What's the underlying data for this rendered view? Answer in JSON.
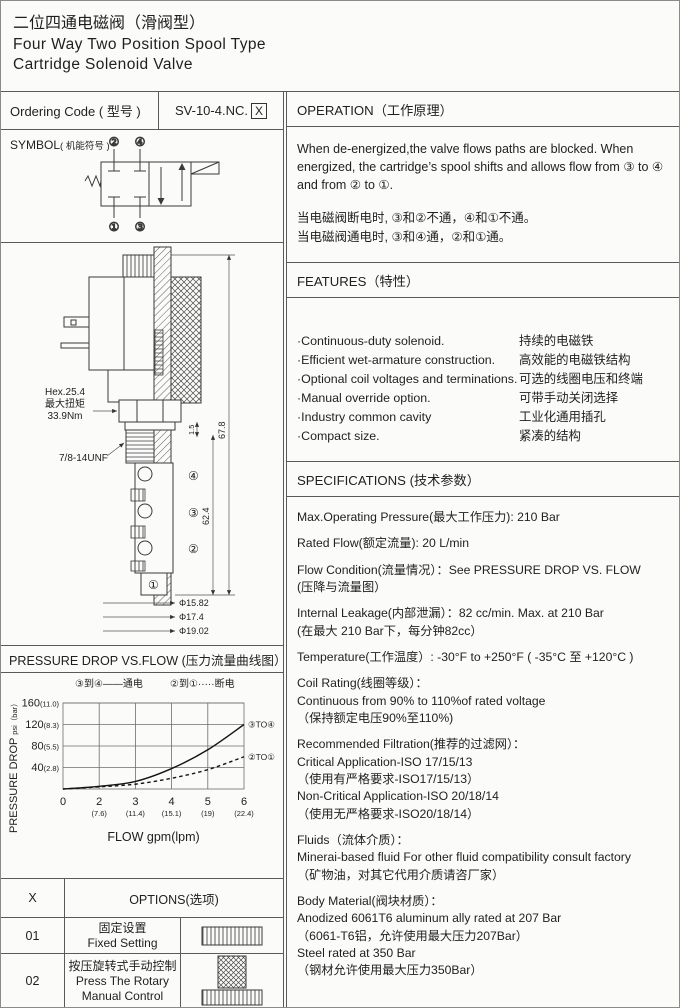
{
  "header": {
    "title_zh": "二位四通电磁阀（滑阀型）",
    "title_en1": "Four Way Two Position Spool Type",
    "title_en2": "Cartridge Solenoid Valve"
  },
  "ordering": {
    "label": "Ordering Code ( 型号 )",
    "code": "SV-10-4.NC.",
    "suffix": "X"
  },
  "symbol": {
    "label": "SYMBOL",
    "label_zh": "( 机能符号 )",
    "ports": [
      "②",
      "④",
      "①",
      "③"
    ],
    "icon_names": [
      "solenoid-actuator-icon",
      "return-spring-icon",
      "flow-arrow-icon",
      "blocked-port-icon"
    ]
  },
  "drawing": {
    "hex_line1": "Hex.25.4",
    "hex_line2": "最大扭矩",
    "hex_line3": "33.9Nm",
    "thread_label": "7/8-14UNF",
    "dim_total": "67.8",
    "dim_gap": "1.5",
    "dim_body": "62.4",
    "dia": [
      "Φ15.82",
      "Φ17.4",
      "Φ19.02"
    ],
    "ports": [
      "④",
      "③",
      "②",
      "①"
    ]
  },
  "operation": {
    "header": "OPERATION（工作原理）",
    "text_en": "When de-energized,the valve flows paths are blocked. When energized, the cartridge’s spool shifts and allows flow from ③ to ④ and from ② to ①.",
    "text_zh": "当电磁阀断电时, ③和②不通，④和①不通。\n当电磁阀通电时, ③和④通，②和①通。"
  },
  "features": {
    "header": "FEATURES（特性）",
    "items": [
      {
        "en": "·Continuous-duty  solenoid.",
        "zh": "持续的电磁铁"
      },
      {
        "en": "·Efficient wet-armature construction.",
        "zh": "高效能的电磁铁结构"
      },
      {
        "en": "·Optional coil voltages and terminations.",
        "zh": "可选的线圈电压和终端"
      },
      {
        "en": "·Manual override option.",
        "zh": "可带手动关闭选择"
      },
      {
        "en": "·Industry common cavity",
        "zh": "工业化通用插孔"
      },
      {
        "en": "·Compact size.",
        "zh": "紧凑的结构"
      }
    ]
  },
  "specifications": {
    "header": "SPECIFICATIONS (技术参数）",
    "blocks": [
      "Max.Operating Pressure(最大工作压力): 210 Bar",
      "Rated Flow(额定流量): 20 L/min",
      "Flow Condition(流量情况）：See PRESSURE DROP VS. FLOW\n(压降与流量图）",
      "Internal Leakage(内部泄漏）：82 cc/min. Max. at 210 Bar\n(在最大 210 Bar下，每分钟82cc）",
      "Temperature(工作温度）: -30°F to +250°F  ( -35°C 至 +120°C )",
      "Coil Rating(线圈等级）：\nContinuous from 90% to 110%of rated voltage\n（保持额定电压90%至110%)",
      "Recommended Filtration(推荐的过滤网）：\nCritical Application-ISO 17/15/13\n（使用有严格要求-ISO17/15/13）\nNon-Critical Application-ISO 20/18/14\n（使用无严格要求-ISO20/18/14）",
      "Fluids（流体介质）：\nMinerai-based fluid For other  fluid compatibility consult  factory\n（矿物油，对其它代用介质请咨厂家）",
      "Body Material(阀块材质）：\nAnodized 6061T6 aluminum ally rated at 207 Bar\n（6061-T6铝，允许使用最大压力207Bar）\nSteel rated at 350 Bar\n（钢材允许使用最大压力350Bar）"
    ]
  },
  "options": {
    "header_x": "X",
    "header_label": "OPTIONS(选项)",
    "rows": [
      {
        "code": "01",
        "label": "固定设置\nFixed Setting",
        "icon": "fixed-setting-knurl-icon"
      },
      {
        "code": "02",
        "label": "按压旋转式手动控制\nPress The Rotary\nManual Control",
        "icon": "rotary-manual-knob-icon"
      }
    ]
  },
  "chart_data": {
    "type": "line",
    "title": "PRESSURE DROP VS.FLOW  (压力流量曲线图）",
    "xlabel": "FLOW gpm(lpm)",
    "ylabel_main": "PRESSURE DROP",
    "ylabel_unit": "psi（bar）",
    "ylim": [
      0,
      160
    ],
    "grid": true,
    "legend_position": "top",
    "x_ticks": [
      {
        "gpm": "0",
        "lpm": ""
      },
      {
        "gpm": "2",
        "lpm": "(7.6)"
      },
      {
        "gpm": "3",
        "lpm": "(11.4)"
      },
      {
        "gpm": "4",
        "lpm": "(15.1)"
      },
      {
        "gpm": "5",
        "lpm": "(19)"
      },
      {
        "gpm": "6",
        "lpm": "(22.4)"
      }
    ],
    "y_ticks": [
      {
        "psi": "40",
        "bar": "(2.8)"
      },
      {
        "psi": "80",
        "bar": "(5.5)"
      },
      {
        "psi": "120",
        "bar": "(8.3)"
      },
      {
        "psi": "160",
        "bar": "(11.0)"
      }
    ],
    "series": [
      {
        "name": "③TO④",
        "legend": "③到④——通电",
        "style": "solid",
        "points_psi": [
          0,
          5,
          14,
          38,
          73,
          120
        ]
      },
      {
        "name": "②TO①",
        "legend": "②到①·····断电",
        "style": "dashed",
        "points_psi": [
          0,
          4,
          9,
          20,
          36,
          60
        ]
      }
    ]
  }
}
